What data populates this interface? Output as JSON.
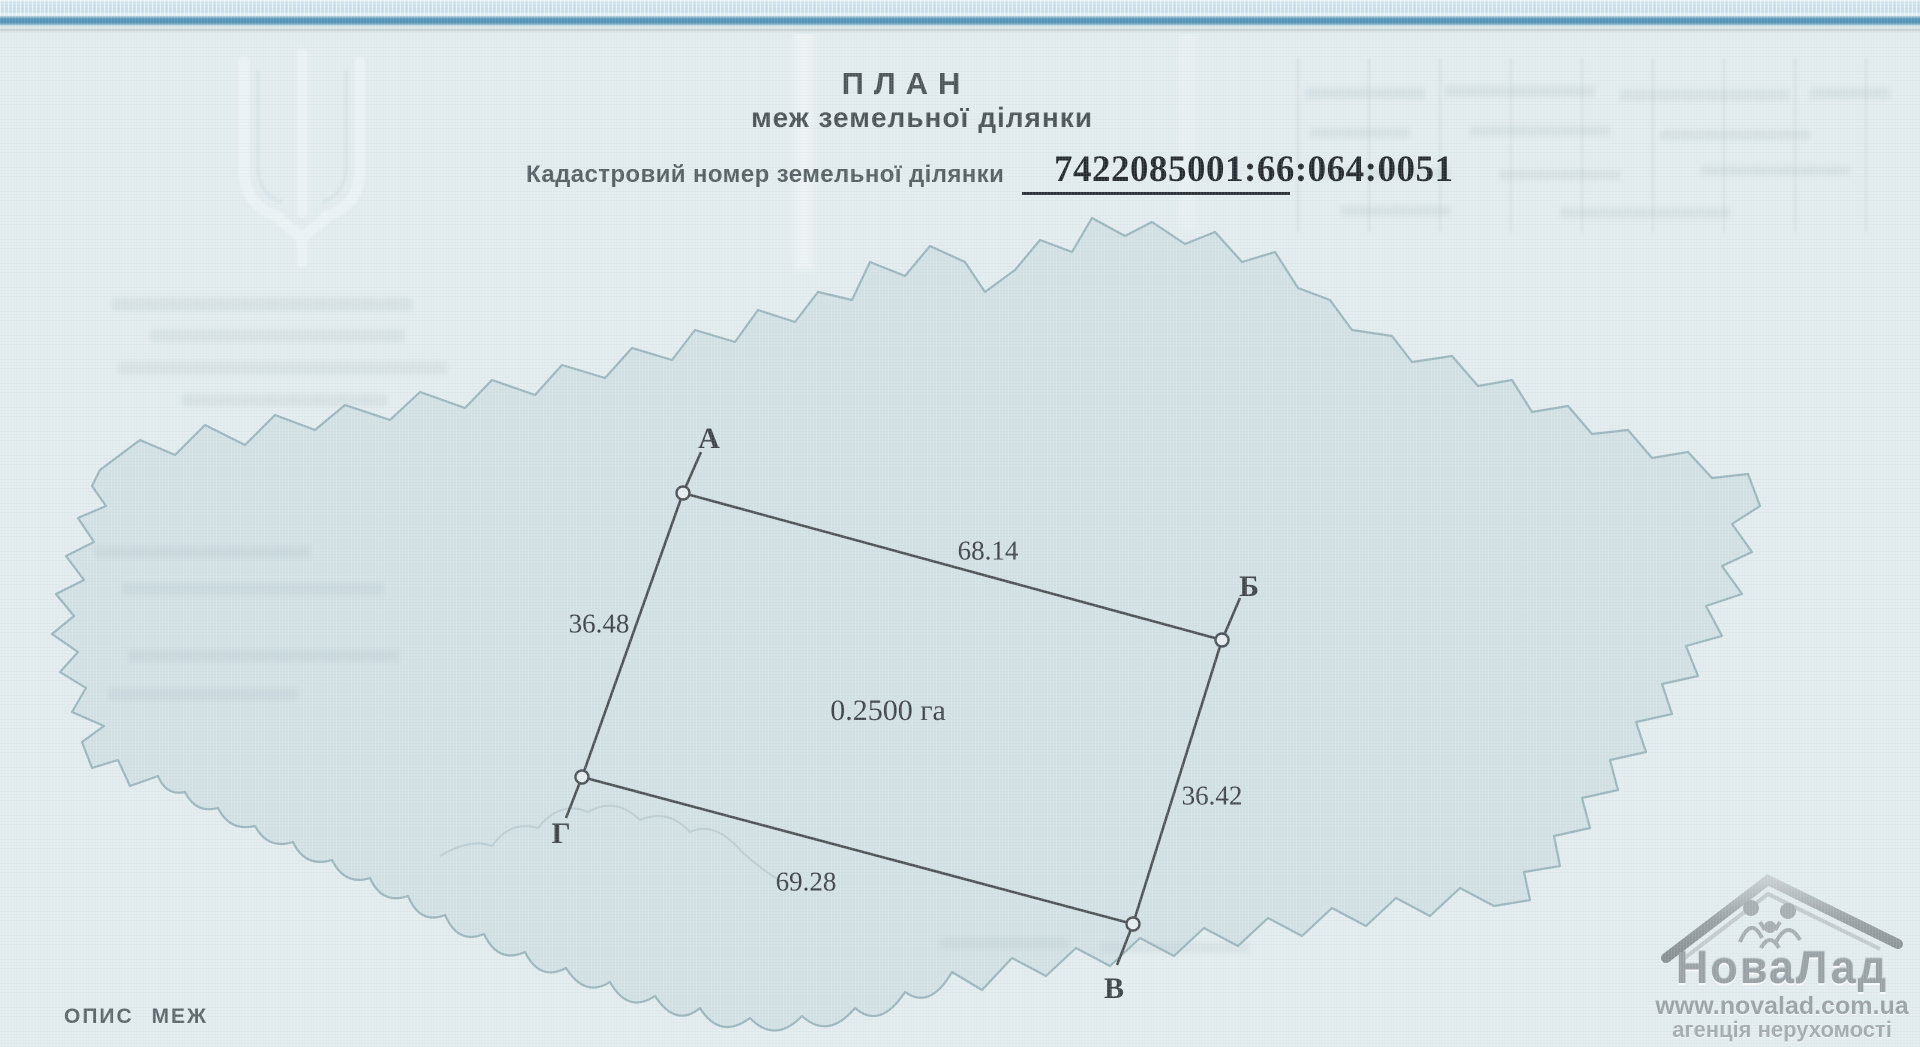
{
  "header": {
    "title": "ПЛАН",
    "subtitle": "меж земельної ділянки",
    "cadastral_label": "Кадастровий номер земельної ділянки",
    "cadastral_number": "7422085001:66:064:0051"
  },
  "plot": {
    "area": "0.2500 га",
    "vertices": [
      {
        "name": "А"
      },
      {
        "name": "Б"
      },
      {
        "name": "В"
      },
      {
        "name": "Г"
      }
    ],
    "sides": [
      {
        "from": "А",
        "to": "Б",
        "length": "68.14"
      },
      {
        "from": "Б",
        "to": "В",
        "length": "36.42"
      },
      {
        "from": "В",
        "to": "Г",
        "length": "69.28"
      },
      {
        "from": "Г",
        "to": "А",
        "length": "36.48"
      }
    ]
  },
  "footer": {
    "heading": "ОПИС МЕЖ"
  },
  "agency_watermark": {
    "brand": "НоваЛад",
    "website": "www.novalad.com.ua",
    "tagline": "агенція нерухомості"
  },
  "icons": {
    "emblem": "ukraine-trident-watermark",
    "map": "ukraine-map-outline-watermark",
    "agency_logo": "house-roof-with-family"
  },
  "colors": {
    "paper": "#e3ecee",
    "map_fill": "#cdddE2",
    "map_outline": "#9db6bd",
    "plot_ink": "#4b5154",
    "band_blue": "#5795b8",
    "heading_text": "#4b5356",
    "agency_gray": "#99a1a4"
  }
}
